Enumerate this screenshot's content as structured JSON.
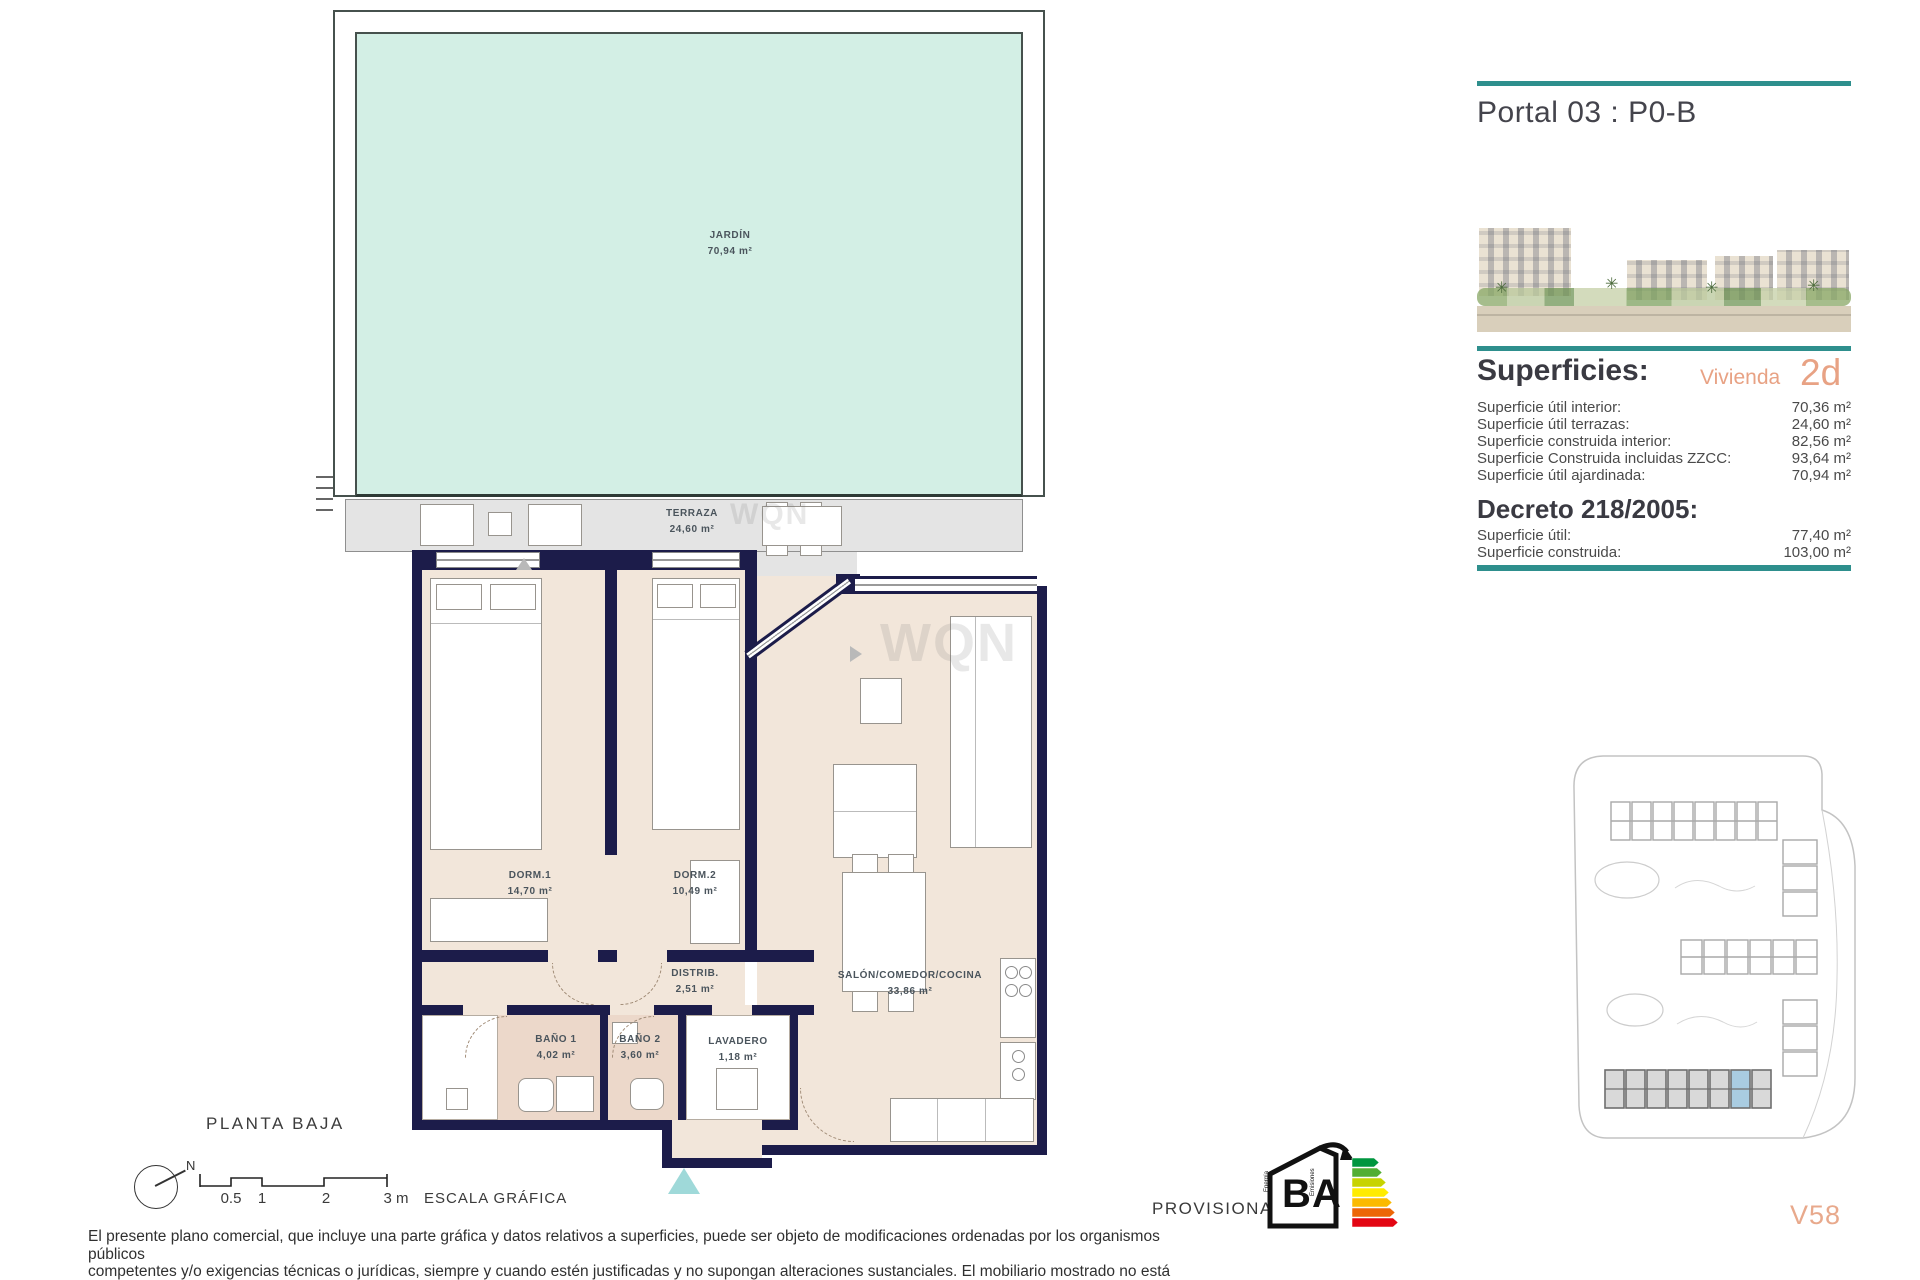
{
  "plan": {
    "floor_label": "PLANTA BAJA",
    "compass_label": "N",
    "watermark": "WQN",
    "scale_bar": {
      "ticks": [
        "0.5",
        "1",
        "2",
        "3 m"
      ],
      "caption": "ESCALA GRÁFICA"
    },
    "rooms": {
      "jardin": {
        "name": "JARDÍN",
        "area": "70,94 m²"
      },
      "terraza": {
        "name": "TERRAZA",
        "area": "24,60 m²"
      },
      "dorm1": {
        "name": "DORM.1",
        "area": "14,70 m²"
      },
      "dorm2": {
        "name": "DORM.2",
        "area": "10,49 m²"
      },
      "distrib": {
        "name": "DISTRIB.",
        "area": "2,51 m²"
      },
      "salon": {
        "name": "SALÓN/COMEDOR/COCINA",
        "area": "33,86 m²"
      },
      "bano1": {
        "name": "BAÑO 1",
        "area": "4,02 m²"
      },
      "bano2": {
        "name": "BAÑO 2",
        "area": "3,60 m²"
      },
      "lavadero": {
        "name": "LAVADERO",
        "area": "1,18 m²"
      }
    }
  },
  "sidebar": {
    "portal_title": "Portal 03 : P0-B",
    "superficies": {
      "heading": "Superficies:",
      "vivienda_label": "Vivienda",
      "vivienda_code": "2d",
      "rows": [
        {
          "label": "Superficie útil interior:",
          "value": "70,36 m²"
        },
        {
          "label": "Superficie útil terrazas:",
          "value": "24,60 m²"
        },
        {
          "label": "Superficie construida interior:",
          "value": "82,56 m²"
        },
        {
          "label": "Superficie Construida incluidas ZZCC:",
          "value": "93,64 m²"
        },
        {
          "label": "Superficie útil ajardinada:",
          "value": "70,94 m²"
        }
      ]
    },
    "decreto": {
      "heading": "Decreto 218/2005:",
      "rows": [
        {
          "label": "Superficie útil:",
          "value": "77,40 m²"
        },
        {
          "label": "Superficie construida:",
          "value": "103,00 m²"
        }
      ]
    },
    "unit_code": "V58"
  },
  "footer": {
    "provisional_label": "PROVISIONAL",
    "energy_badge": {
      "letter_b": "B",
      "letter_a": "A",
      "label_energia": "Energía",
      "label_emisiones": "Emisiones"
    },
    "disclaimer_lines": [
      "El presente plano comercial, que incluye una parte gráfica y datos relativos a superficies, puede ser objeto de modificaciones ordenadas por los organismos públicos",
      "competentes y/o exigencias técnicas o jurídicas, siempre y cuando estén justificadas y no supongan alteraciones sustanciales. El mobiliario mostrado no está incluido",
      "y el equipamiento del inmueble será el indicado en la correspondiente memoria de calidades."
    ]
  },
  "colors": {
    "accent_teal": "#2e8f8d",
    "accent_salmon": "#e8a284",
    "wall_navy": "#1c1c4a",
    "garden_green": "#d3efe5",
    "terrace_grey": "#e4e4e4",
    "interior_beige": "#f2e6da"
  }
}
